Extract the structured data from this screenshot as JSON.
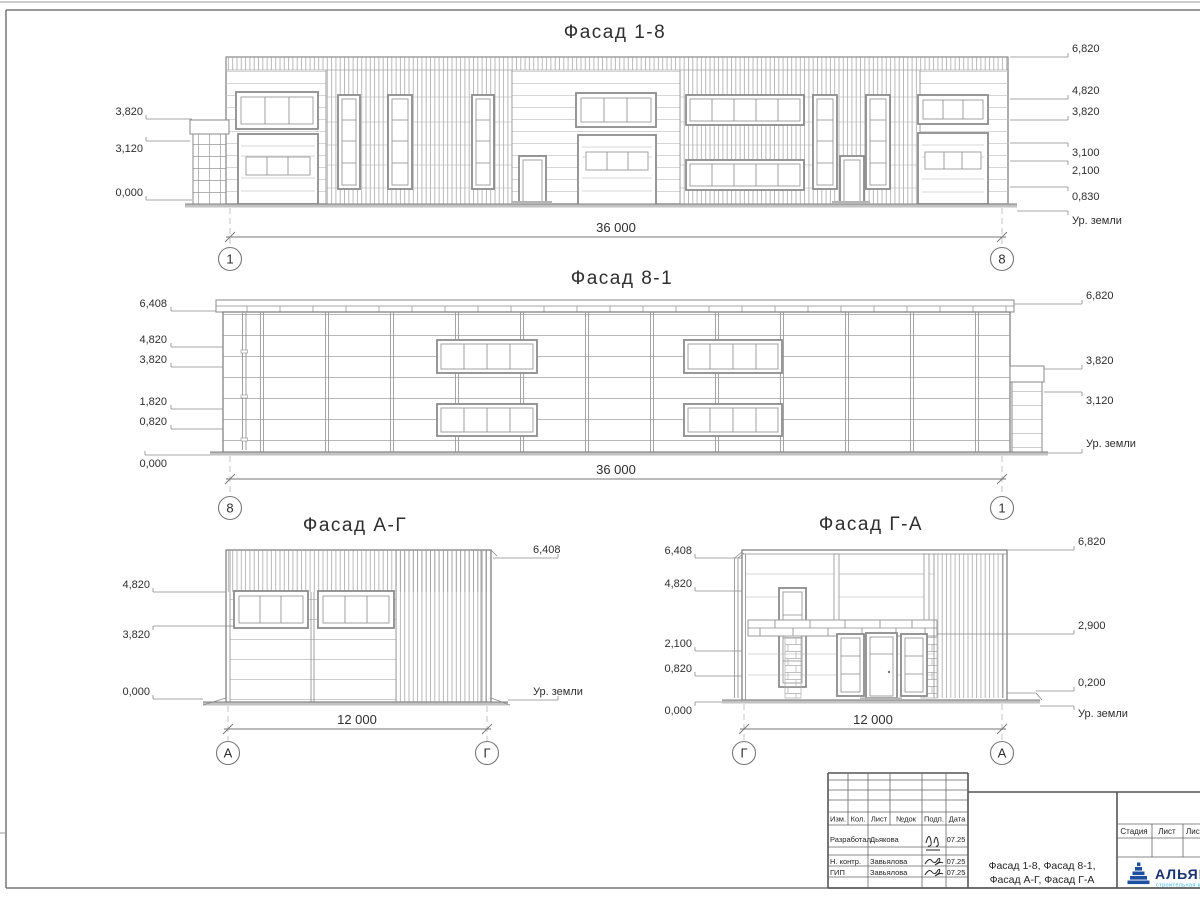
{
  "f18": {
    "title": "Фасад 1-8",
    "dim": "36 000",
    "axes": [
      "1",
      "8"
    ],
    "marks_left": [
      "3,820",
      "3,120",
      "0,000"
    ],
    "marks_right": [
      "6,820",
      "4,820",
      "3,820",
      "3,100",
      "2,100",
      "0,830",
      "Ур. земли"
    ]
  },
  "f81": {
    "title": "Фасад 8-1",
    "dim": "36 000",
    "axes": [
      "8",
      "1"
    ],
    "marks_left": [
      "6,408",
      "4,820",
      "3,820",
      "1,820",
      "0,820",
      "0,000"
    ],
    "marks_right": [
      "6,820",
      "3,820",
      "3,120",
      "Ур. земли"
    ]
  },
  "fag": {
    "title": "Фасад А-Г",
    "dim": "12 000",
    "axes": [
      "А",
      "Г"
    ],
    "marks_left": [
      "4,820",
      "3,820",
      "0,000"
    ],
    "marks_right": [
      "6,408",
      "Ур. земли"
    ]
  },
  "fga": {
    "title": "Фасад Г-А",
    "dim": "12 000",
    "axes": [
      "Г",
      "А"
    ],
    "marks_left": [
      "6,408",
      "4,820",
      "2,100",
      "0,820",
      "0,000"
    ],
    "marks_right": [
      "6,820",
      "2,900",
      "0,200",
      "Ур. земли"
    ]
  },
  "title_block": {
    "header_cols": [
      "Изм.",
      "Кол.",
      "Лист",
      "№док",
      "Подп.",
      "Дата"
    ],
    "rows": [
      {
        "role": "Разработал",
        "name": "Дьякова",
        "date": "07.25"
      },
      {
        "role": "Н. контр.",
        "name": "Завьялова",
        "date": "07.25"
      },
      {
        "role": "ГИП",
        "name": "Завьялова",
        "date": "07.25"
      }
    ],
    "doc_title_1": "Фасад 1-8, Фасад 8-1,",
    "doc_title_2": "Фасад А-Г, Фасад Г-А",
    "stage_label": "Стадия",
    "sheet_label": "Лист",
    "sheets_label": "Листов",
    "company": "АЛЬЯНС",
    "company_sub": "строительная компания"
  }
}
